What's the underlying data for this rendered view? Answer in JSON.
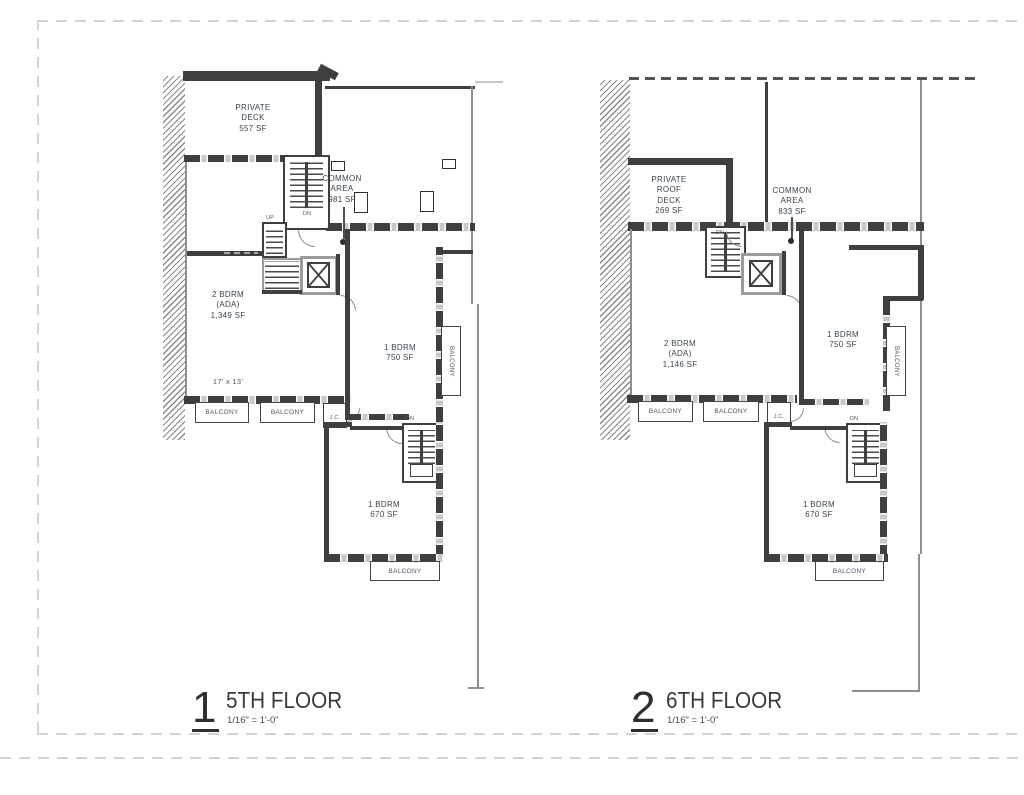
{
  "sheet": {
    "type": "architectural floor plan sheet",
    "line_color": "#3f3f3f",
    "border_color": "#d2d2d2"
  },
  "plans": [
    {
      "number": "1",
      "title": "5TH FLOOR",
      "scale": "1/16\" = 1'-0\"",
      "private_deck": "PRIVATE\nDECK\n557 SF",
      "common_area": "COMMON\nAREA\n981 SF",
      "unit_2bdrm": "2 BDRM\n(ADA)\n1,349 SF",
      "room_dim": "17' x 13'",
      "unit_1bdrm": "1 BDRM\n750 SF",
      "unit_1bdrm_lower": "1 BDRM\n670 SF",
      "balcony": "BALCONY",
      "jc": "J.C.",
      "dn": "DN",
      "up": "UP"
    },
    {
      "number": "2",
      "title": "6TH FLOOR",
      "scale": "1/16\" = 1'-0\"",
      "private_deck": "PRIVATE\nROOF\nDECK\n269 SF",
      "common_area": "COMMON\nAREA\n833 SF",
      "unit_2bdrm": "2 BDRM\n(ADA)\n1,146 SF",
      "unit_1bdrm": "1 BDRM\n750 SF",
      "unit_1bdrm_lower": "1 BDRM\n670 SF",
      "balcony": "BALCONY",
      "jc": "J.C.",
      "dn": "DN"
    }
  ]
}
